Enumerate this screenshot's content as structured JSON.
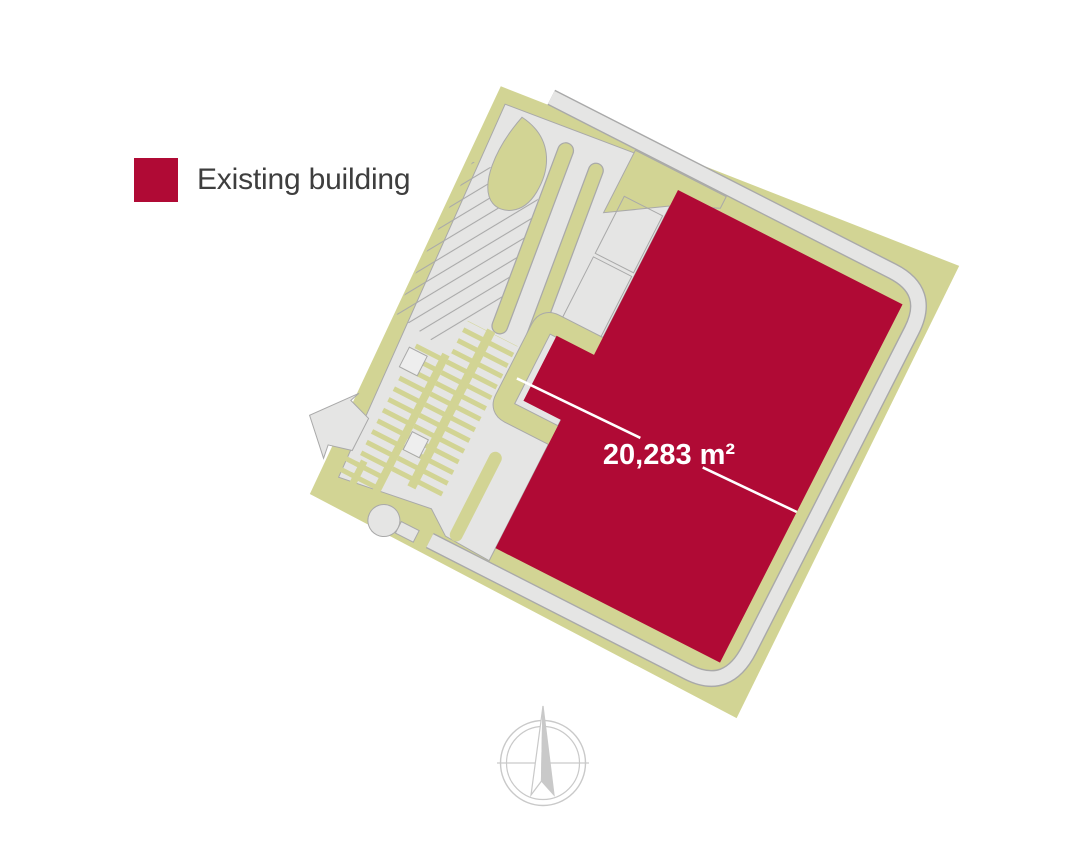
{
  "legend": {
    "label": "Existing building",
    "swatch_color": "#b00a35"
  },
  "site_plan": {
    "area_label": "20,283 m²",
    "colors": {
      "existing_building": "#b00a35",
      "landscape": "#d2d494",
      "pavement": "#e5e5e4",
      "outline": "#a9a9a9",
      "dimension_line": "#ffffff"
    }
  },
  "compass": {
    "icon": "compass-north-arrow-icon",
    "color": "#c9c9c9"
  }
}
